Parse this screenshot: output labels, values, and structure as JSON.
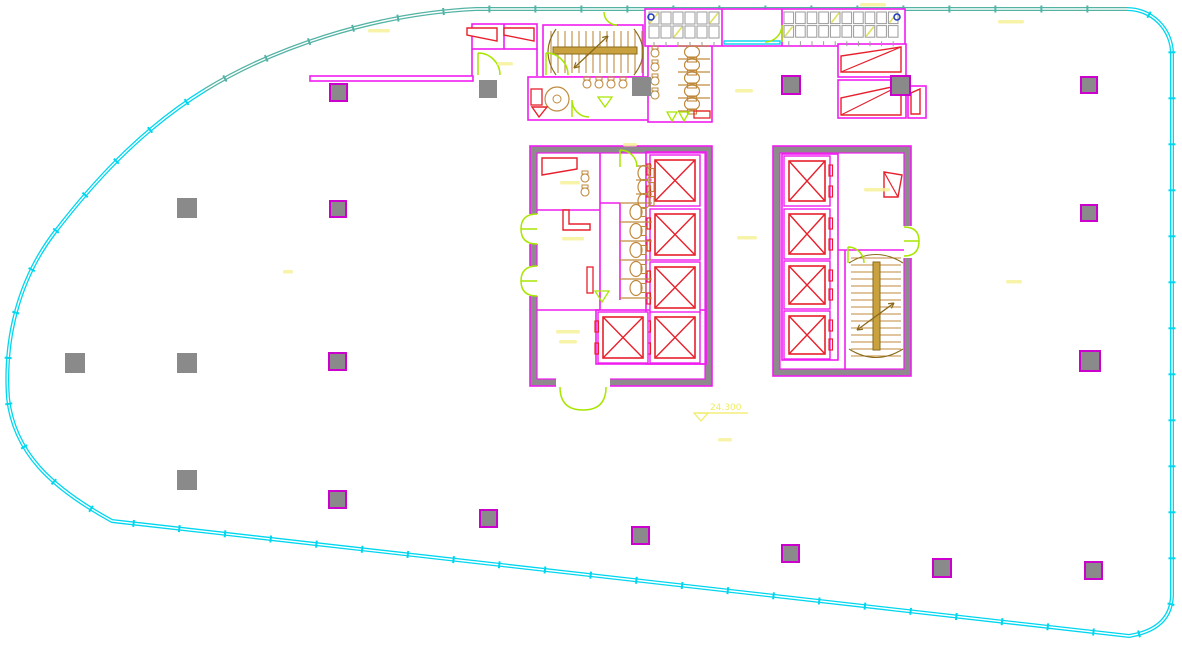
{
  "title": "architectural-floor-plan",
  "labels": {
    "level": "24.300"
  },
  "colors": {
    "teal": "#53b3a5",
    "cyan": "#00d6ee",
    "magenta": "#f01ef0",
    "magenta_dark": "#cc00cc",
    "poche": "#8e8a8e",
    "column_gray": "#8a8a8a",
    "red": "#e8202c",
    "tan": "#c08a3e",
    "gold": "#c9a23f",
    "gold_dark": "#8a6a1a",
    "green": "#a8e600",
    "yellow": "#f0ec60",
    "faint_yellow": "#f6f29b",
    "grid_gray": "#9a9a9a",
    "blue": "#2038c8"
  },
  "drawing": {
    "boundary": {
      "teal_path": "M 205 90 C 270 50 370 14 476 9 L 1127 9",
      "cyan_path": "M 1127 9 A 45 45 0 0 1 1172 54 L 1172 594 Q 1172 629 1129 636 L 112 521 C 50 487 14 452 8 398 C 4 340 18 280 55 232 C 92 184 140 130 205 90",
      "tick_spacing": 46,
      "tick_len": 7
    },
    "columns": [
      {
        "x": 479,
        "y": 80,
        "s": 18,
        "m": false
      },
      {
        "x": 330,
        "y": 84,
        "s": 17,
        "m": true
      },
      {
        "x": 632,
        "y": 77,
        "s": 19,
        "m": false
      },
      {
        "x": 782,
        "y": 76,
        "s": 18,
        "m": true
      },
      {
        "x": 891,
        "y": 76,
        "s": 19,
        "m": true
      },
      {
        "x": 1081,
        "y": 77,
        "s": 16,
        "m": true
      },
      {
        "x": 177,
        "y": 198,
        "s": 20,
        "m": false
      },
      {
        "x": 330,
        "y": 201,
        "s": 16,
        "m": true
      },
      {
        "x": 1081,
        "y": 205,
        "s": 16,
        "m": true
      },
      {
        "x": 65,
        "y": 353,
        "s": 20,
        "m": false
      },
      {
        "x": 177,
        "y": 353,
        "s": 20,
        "m": false
      },
      {
        "x": 329,
        "y": 353,
        "s": 17,
        "m": true
      },
      {
        "x": 1080,
        "y": 351,
        "s": 20,
        "m": true
      },
      {
        "x": 177,
        "y": 470,
        "s": 20,
        "m": false
      },
      {
        "x": 329,
        "y": 491,
        "s": 17,
        "m": true
      },
      {
        "x": 480,
        "y": 510,
        "s": 17,
        "m": true
      },
      {
        "x": 632,
        "y": 527,
        "s": 17,
        "m": true
      },
      {
        "x": 782,
        "y": 545,
        "s": 17,
        "m": true
      },
      {
        "x": 933,
        "y": 559,
        "s": 18,
        "m": true
      },
      {
        "x": 1085,
        "y": 562,
        "s": 17,
        "m": true
      }
    ],
    "wall_rects": [
      {
        "x": 310,
        "y": 76,
        "w": 163,
        "h": 5
      },
      {
        "x": 472,
        "y": 24,
        "w": 65,
        "h": 25
      },
      {
        "x": 543,
        "y": 25,
        "w": 100,
        "h": 52
      },
      {
        "x": 528,
        "y": 77,
        "w": 134,
        "h": 43
      },
      {
        "x": 648,
        "y": 46,
        "w": 64,
        "h": 76
      },
      {
        "x": 645,
        "y": 9,
        "w": 260,
        "h": 37
      },
      {
        "x": 838,
        "y": 44,
        "w": 68,
        "h": 33
      },
      {
        "x": 838,
        "y": 80,
        "w": 68,
        "h": 38
      },
      {
        "x": 908,
        "y": 86,
        "w": 18,
        "h": 32
      }
    ],
    "wall_lines": [
      {
        "x1": 504,
        "y1": 24,
        "x2": 504,
        "y2": 49
      },
      {
        "x1": 472,
        "y1": 49,
        "x2": 472,
        "y2": 76
      },
      {
        "x1": 537,
        "y1": 49,
        "x2": 537,
        "y2": 76
      },
      {
        "x1": 722,
        "y1": 9,
        "x2": 722,
        "y2": 46
      },
      {
        "x1": 782,
        "y1": 9,
        "x2": 782,
        "y2": 46
      },
      {
        "x1": 600,
        "y1": 153,
        "x2": 600,
        "y2": 310
      },
      {
        "x1": 537,
        "y1": 210,
        "x2": 600,
        "y2": 210
      },
      {
        "x1": 537,
        "y1": 310,
        "x2": 600,
        "y2": 310
      },
      {
        "x1": 620,
        "y1": 203,
        "x2": 620,
        "y2": 300
      },
      {
        "x1": 600,
        "y1": 203,
        "x2": 620,
        "y2": 203
      },
      {
        "x1": 838,
        "y1": 250,
        "x2": 904,
        "y2": 250
      },
      {
        "x1": 845,
        "y1": 250,
        "x2": 845,
        "y2": 370
      }
    ],
    "cores": [
      {
        "outer": {
          "x": 530,
          "y": 146,
          "w": 182,
          "h": 240
        },
        "inner": {
          "x": 537,
          "y": 153,
          "w": 168,
          "h": 226
        }
      },
      {
        "outer": {
          "x": 773,
          "y": 146,
          "w": 138,
          "h": 230
        },
        "inner": {
          "x": 780,
          "y": 153,
          "w": 124,
          "h": 216
        }
      }
    ],
    "openings": [
      {
        "x": 529,
        "y": 214,
        "w": 9,
        "h": 30
      },
      {
        "x": 529,
        "y": 266,
        "w": 9,
        "h": 30
      },
      {
        "x": 556,
        "y": 378,
        "w": 54,
        "h": 9
      },
      {
        "x": 903,
        "y": 226,
        "w": 9,
        "h": 32
      }
    ],
    "bank_rects": [
      {
        "x": 646,
        "y": 152,
        "w": 60,
        "h": 212
      },
      {
        "x": 596,
        "y": 310,
        "w": 110,
        "h": 54
      },
      {
        "x": 782,
        "y": 154,
        "w": 56,
        "h": 206
      }
    ],
    "elevators": [
      {
        "x": 655,
        "y": 160,
        "w": 40,
        "h": 41,
        "door": "left"
      },
      {
        "x": 655,
        "y": 214,
        "w": 40,
        "h": 41,
        "door": "left"
      },
      {
        "x": 655,
        "y": 267,
        "w": 40,
        "h": 41,
        "door": "left"
      },
      {
        "x": 655,
        "y": 317,
        "w": 40,
        "h": 41,
        "door": "left"
      },
      {
        "x": 603,
        "y": 317,
        "w": 40,
        "h": 41,
        "door": "left"
      },
      {
        "x": 789,
        "y": 161,
        "w": 36,
        "h": 40,
        "door": "right"
      },
      {
        "x": 789,
        "y": 214,
        "w": 36,
        "h": 40,
        "door": "right"
      },
      {
        "x": 789,
        "y": 266,
        "w": 36,
        "h": 38,
        "door": "right"
      },
      {
        "x": 789,
        "y": 316,
        "w": 36,
        "h": 38,
        "door": "right"
      }
    ],
    "grilles": [
      {
        "x": 649,
        "y": 12,
        "cols": 6,
        "rows": 2,
        "cell": 12,
        "marks": [
          [
            0,
            0
          ],
          [
            2,
            1
          ],
          [
            5,
            0
          ]
        ]
      },
      {
        "x": 784,
        "y": 12,
        "cols": 10,
        "rows": 2,
        "cell": 11.6,
        "marks": [
          [
            0,
            1
          ],
          [
            4,
            0
          ],
          [
            7,
            1
          ],
          [
            9,
            0
          ]
        ]
      }
    ],
    "blue_dots": [
      {
        "cx": 651,
        "cy": 17
      },
      {
        "cx": 897,
        "cy": 17
      }
    ],
    "cyan_door": {
      "x": 724,
      "y": 41,
      "w": 56,
      "h": 3
    },
    "stairs": [
      {
        "dir": "h",
        "x": 551,
        "y": 29,
        "w": 88,
        "h": 46,
        "treads": 13,
        "step": 7,
        "rail": {
          "x": 553,
          "y": 47,
          "w": 84,
          "h": 7
        },
        "arcs": [
          "M556 29 Q540 52 556 75",
          "M634 29 Q652 52 634 75"
        ],
        "arrow": {
          "x1": 574,
          "y1": 68,
          "x2": 608,
          "y2": 36
        }
      },
      {
        "dir": "v",
        "x": 851,
        "y": 258,
        "w": 50,
        "h": 96,
        "treads": 14,
        "step": 7,
        "rail": {
          "x": 873,
          "y": 262,
          "w": 7,
          "h": 88
        },
        "arcs": [
          "M849 263 Q876 246 903 263",
          "M849 349 Q876 366 903 349"
        ],
        "arrow": {
          "x1": 857,
          "y1": 330,
          "x2": 894,
          "y2": 303
        }
      }
    ],
    "stall_lines": [
      {
        "x1": 620,
        "y1": 203,
        "x2": 652,
        "y2": 203
      },
      {
        "x1": 620,
        "y1": 222,
        "x2": 652,
        "y2": 222
      },
      {
        "x1": 620,
        "y1": 241,
        "x2": 652,
        "y2": 241
      },
      {
        "x1": 620,
        "y1": 260,
        "x2": 652,
        "y2": 260
      },
      {
        "x1": 620,
        "y1": 279,
        "x2": 652,
        "y2": 279
      },
      {
        "x1": 620,
        "y1": 298,
        "x2": 652,
        "y2": 298
      },
      {
        "x1": 636,
        "y1": 166,
        "x2": 652,
        "y2": 166
      },
      {
        "x1": 636,
        "y1": 180,
        "x2": 652,
        "y2": 180
      },
      {
        "x1": 636,
        "y1": 194,
        "x2": 652,
        "y2": 194
      },
      {
        "x1": 678,
        "y1": 46,
        "x2": 710,
        "y2": 46
      },
      {
        "x1": 678,
        "y1": 59,
        "x2": 710,
        "y2": 59
      },
      {
        "x1": 678,
        "y1": 72,
        "x2": 710,
        "y2": 72
      },
      {
        "x1": 678,
        "y1": 85,
        "x2": 710,
        "y2": 85
      },
      {
        "x1": 678,
        "y1": 98,
        "x2": 710,
        "y2": 98
      },
      {
        "x1": 678,
        "y1": 111,
        "x2": 710,
        "y2": 111
      }
    ],
    "wcs": [
      {
        "cx": 636,
        "cy": 212,
        "rot": 0
      },
      {
        "cx": 636,
        "cy": 231,
        "rot": 0
      },
      {
        "cx": 636,
        "cy": 250,
        "rot": 0
      },
      {
        "cx": 636,
        "cy": 269,
        "rot": 0
      },
      {
        "cx": 636,
        "cy": 288,
        "rot": 0
      },
      {
        "cx": 644,
        "cy": 173,
        "rot": 0
      },
      {
        "cx": 644,
        "cy": 187,
        "rot": 0
      },
      {
        "cx": 644,
        "cy": 201,
        "rot": 0
      },
      {
        "cx": 692,
        "cy": 52,
        "rot": 90
      },
      {
        "cx": 692,
        "cy": 65,
        "rot": 90
      },
      {
        "cx": 692,
        "cy": 78,
        "rot": 90
      },
      {
        "cx": 692,
        "cy": 91,
        "rot": 90
      },
      {
        "cx": 692,
        "cy": 104,
        "rot": 90
      }
    ],
    "urinals": [
      {
        "cx": 585,
        "cy": 178
      },
      {
        "cx": 585,
        "cy": 192
      },
      {
        "cx": 655,
        "cy": 53
      },
      {
        "cx": 655,
        "cy": 67
      },
      {
        "cx": 655,
        "cy": 81
      },
      {
        "cx": 655,
        "cy": 95
      },
      {
        "cx": 587,
        "cy": 84
      },
      {
        "cx": 599,
        "cy": 84
      },
      {
        "cx": 611,
        "cy": 84
      },
      {
        "cx": 623,
        "cy": 84
      }
    ],
    "basin": {
      "cx": 557,
      "cy": 99,
      "r": 12,
      "r2": 4
    },
    "doors": [
      "M478 53 L478 75 M478 53 A22 22 0 0 1 500 75",
      "M546 53 L546 75 M546 53 A22 22 0 0 1 568 75",
      "M782 25 L782 42 M782 25 A17 17 0 0 1 765 42",
      "M572 100 L572 117 M572 100 A17 17 0 0 0 589 117",
      "M620 150 L620 167 M620 150 A17 17 0 0 1 637 167",
      "M537 214 Q521 214 521 229 L537 229 M537 244 Q521 244 521 229",
      "M537 266 Q521 266 521 281 L537 281 M537 296 Q521 296 521 281",
      "M560 387 Q560 410 583 410 M606 387 Q606 410 583 410",
      "M904 227 Q919 227 919 241 L904 241 M904 256 Q919 256 919 241",
      "M848 247 L848 263 M848 247 A16 16 0 0 1 864 263",
      "M604 12 A13 13 0 0 0 617 25"
    ],
    "green_triangles": [
      "598,97 612,97 605,107",
      "595,291 609,291 602,302",
      "667,112 677,112 672,121",
      "679,112 689,112 684,121"
    ],
    "red_polys": [
      "467,28 497,28 497,41 467,35",
      "504,28 534,28 534,41 504,35",
      "841,72 841,56 901,47 901,72",
      "841,115 841,98 901,85 901,115",
      "911,114 911,93 920,89 920,114",
      "884,172 902,175 898,197 884,197",
      "542,158 577,158 577,169 542,175",
      "563,210 563,230 590,230 590,224 569,224 569,210",
      "532,107 547,107 539,117"
    ],
    "red_lines": [
      {
        "x1": 841,
        "y1": 72,
        "x2": 901,
        "y2": 47
      },
      {
        "x1": 841,
        "y1": 115,
        "x2": 901,
        "y2": 85
      },
      {
        "x1": 884,
        "y1": 172,
        "x2": 898,
        "y2": 197
      }
    ],
    "red_rects": [
      {
        "x": 587,
        "y": 267,
        "w": 6,
        "h": 26
      },
      {
        "x": 531,
        "y": 89,
        "w": 11,
        "h": 16
      },
      {
        "x": 694,
        "y": 111,
        "w": 16,
        "h": 7
      }
    ],
    "level_marker": {
      "lx1": 697,
      "ly1": 413,
      "lx2": 748,
      "ly2": 413,
      "tri": "694,413 708,413 701,421",
      "tx": 710,
      "ty": 410
    },
    "faint_labels": [
      {
        "x": 368,
        "y": 29,
        "w": 22
      },
      {
        "x": 860,
        "y": 3,
        "w": 26
      },
      {
        "x": 998,
        "y": 20,
        "w": 26
      },
      {
        "x": 497,
        "y": 62,
        "w": 16
      },
      {
        "x": 735,
        "y": 89,
        "w": 18
      },
      {
        "x": 560,
        "y": 181,
        "w": 20
      },
      {
        "x": 562,
        "y": 237,
        "w": 22
      },
      {
        "x": 556,
        "y": 330,
        "w": 24
      },
      {
        "x": 559,
        "y": 340,
        "w": 18
      },
      {
        "x": 737,
        "y": 236,
        "w": 20
      },
      {
        "x": 864,
        "y": 188,
        "w": 26
      },
      {
        "x": 623,
        "y": 143,
        "w": 14
      },
      {
        "x": 1006,
        "y": 280,
        "w": 16
      },
      {
        "x": 718,
        "y": 438,
        "w": 14
      },
      {
        "x": 283,
        "y": 270,
        "w": 10
      }
    ]
  }
}
